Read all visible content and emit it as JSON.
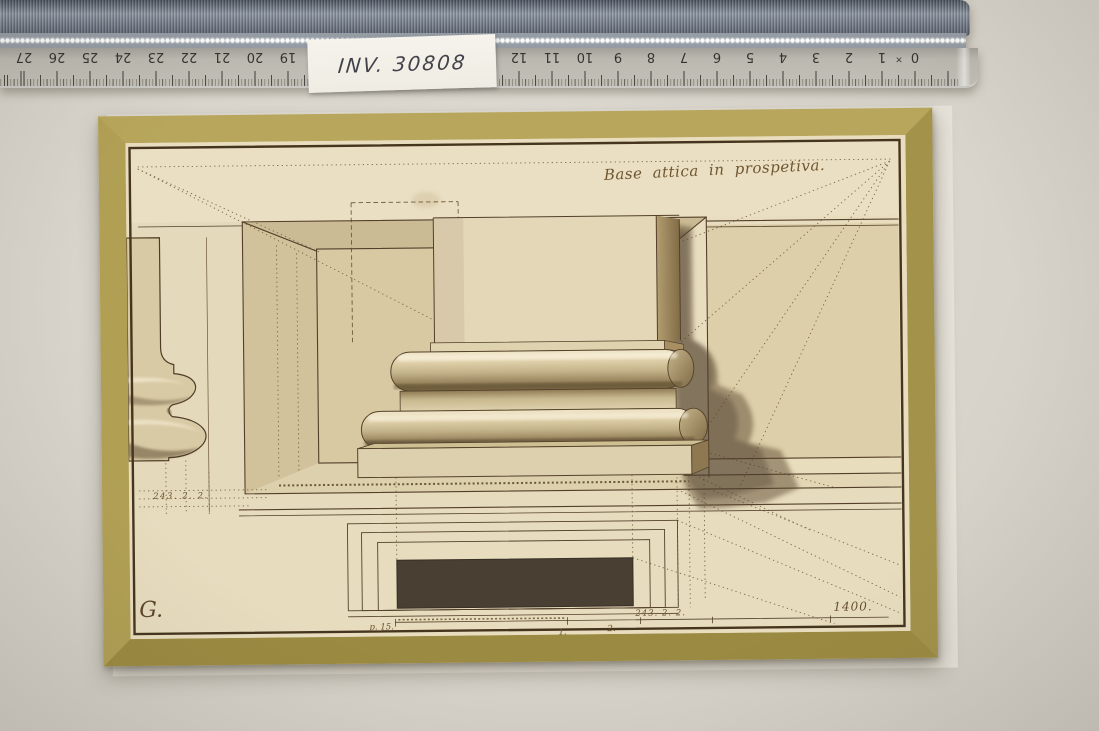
{
  "scene": {
    "backdrop_color": "#d9d5cc",
    "ruler": {
      "numbers_left": [
        "27",
        "26",
        "25",
        "24",
        "23",
        "22",
        "21",
        "20",
        "19",
        "18"
      ],
      "numbers_right": [
        "12",
        "11",
        "10",
        "9",
        "8",
        "7",
        "6",
        "5",
        "4",
        "3",
        "2",
        "1",
        "0"
      ],
      "times_mark": "×"
    },
    "inventory_sticker": {
      "label": "INV. 30808"
    },
    "sheet": {
      "mount_color": "#ab9a4e",
      "paper_color": "#e8ddbf",
      "ink_color": "#54402a",
      "inscription": "Base attica in prospetiva.",
      "signature": "G.",
      "annotations": {
        "left_registry": "243. 2. 2.",
        "scale_label": "p. 15.",
        "scale_one": "1.",
        "scale_two": "2.",
        "right_registry": "243. 2. 2.",
        "corner_number": "1400."
      }
    }
  }
}
